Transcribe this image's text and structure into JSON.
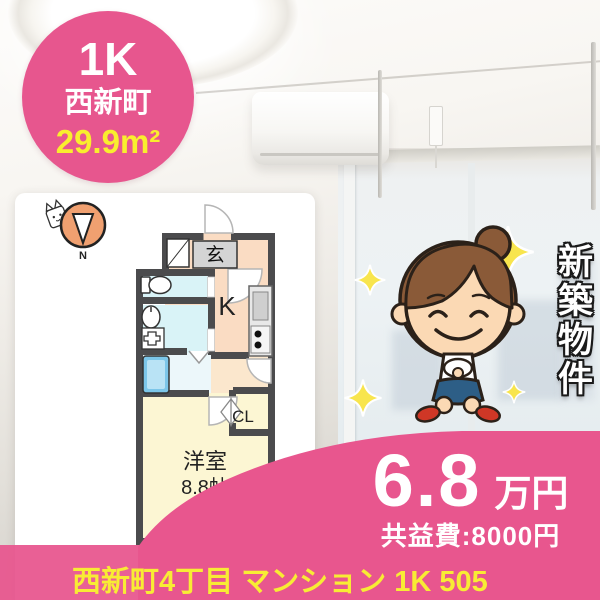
{
  "badge": {
    "layout": "1K",
    "town": "西新町",
    "area": "29.9m²"
  },
  "floor_plan": {
    "labels": {
      "compass_north": "N",
      "entrance": "玄",
      "kitchen": "K",
      "closet": "CL",
      "main_room": "洋室",
      "main_room_size": "8.8帖",
      "balcony": "バルコニー"
    }
  },
  "banner": {
    "vertical_text": "新築物件"
  },
  "price": {
    "amount": "6.8",
    "unit": "万円",
    "fee": "共益費:8000円"
  },
  "footer": {
    "address": "西新町4丁目 マンション 1K 505"
  },
  "colors": {
    "accent_pink": "#e8568e",
    "address_yellow": "#f8ec34",
    "badge_area_yellow": "#f9ee2e",
    "plan_wall": "#4b4b4d",
    "compass_orange": "#f0a070",
    "kitchen_fill": "#fadcc3",
    "corridor_fill": "#fbe7cd",
    "closet_fill": "#f5c98f",
    "wet_area_fill": "#d9f3f7",
    "bath_fill": "#ecf7fa",
    "main_room_fill": "#fcf6d3",
    "tub_blue": "#7cc6e9",
    "hair_brown": "#8a5a38",
    "skin_tone": "#fbd9b4",
    "skirt_navy": "#2d5e86",
    "shoes_red": "#cf3726",
    "sparkle_yellow": "#f8e54d"
  }
}
